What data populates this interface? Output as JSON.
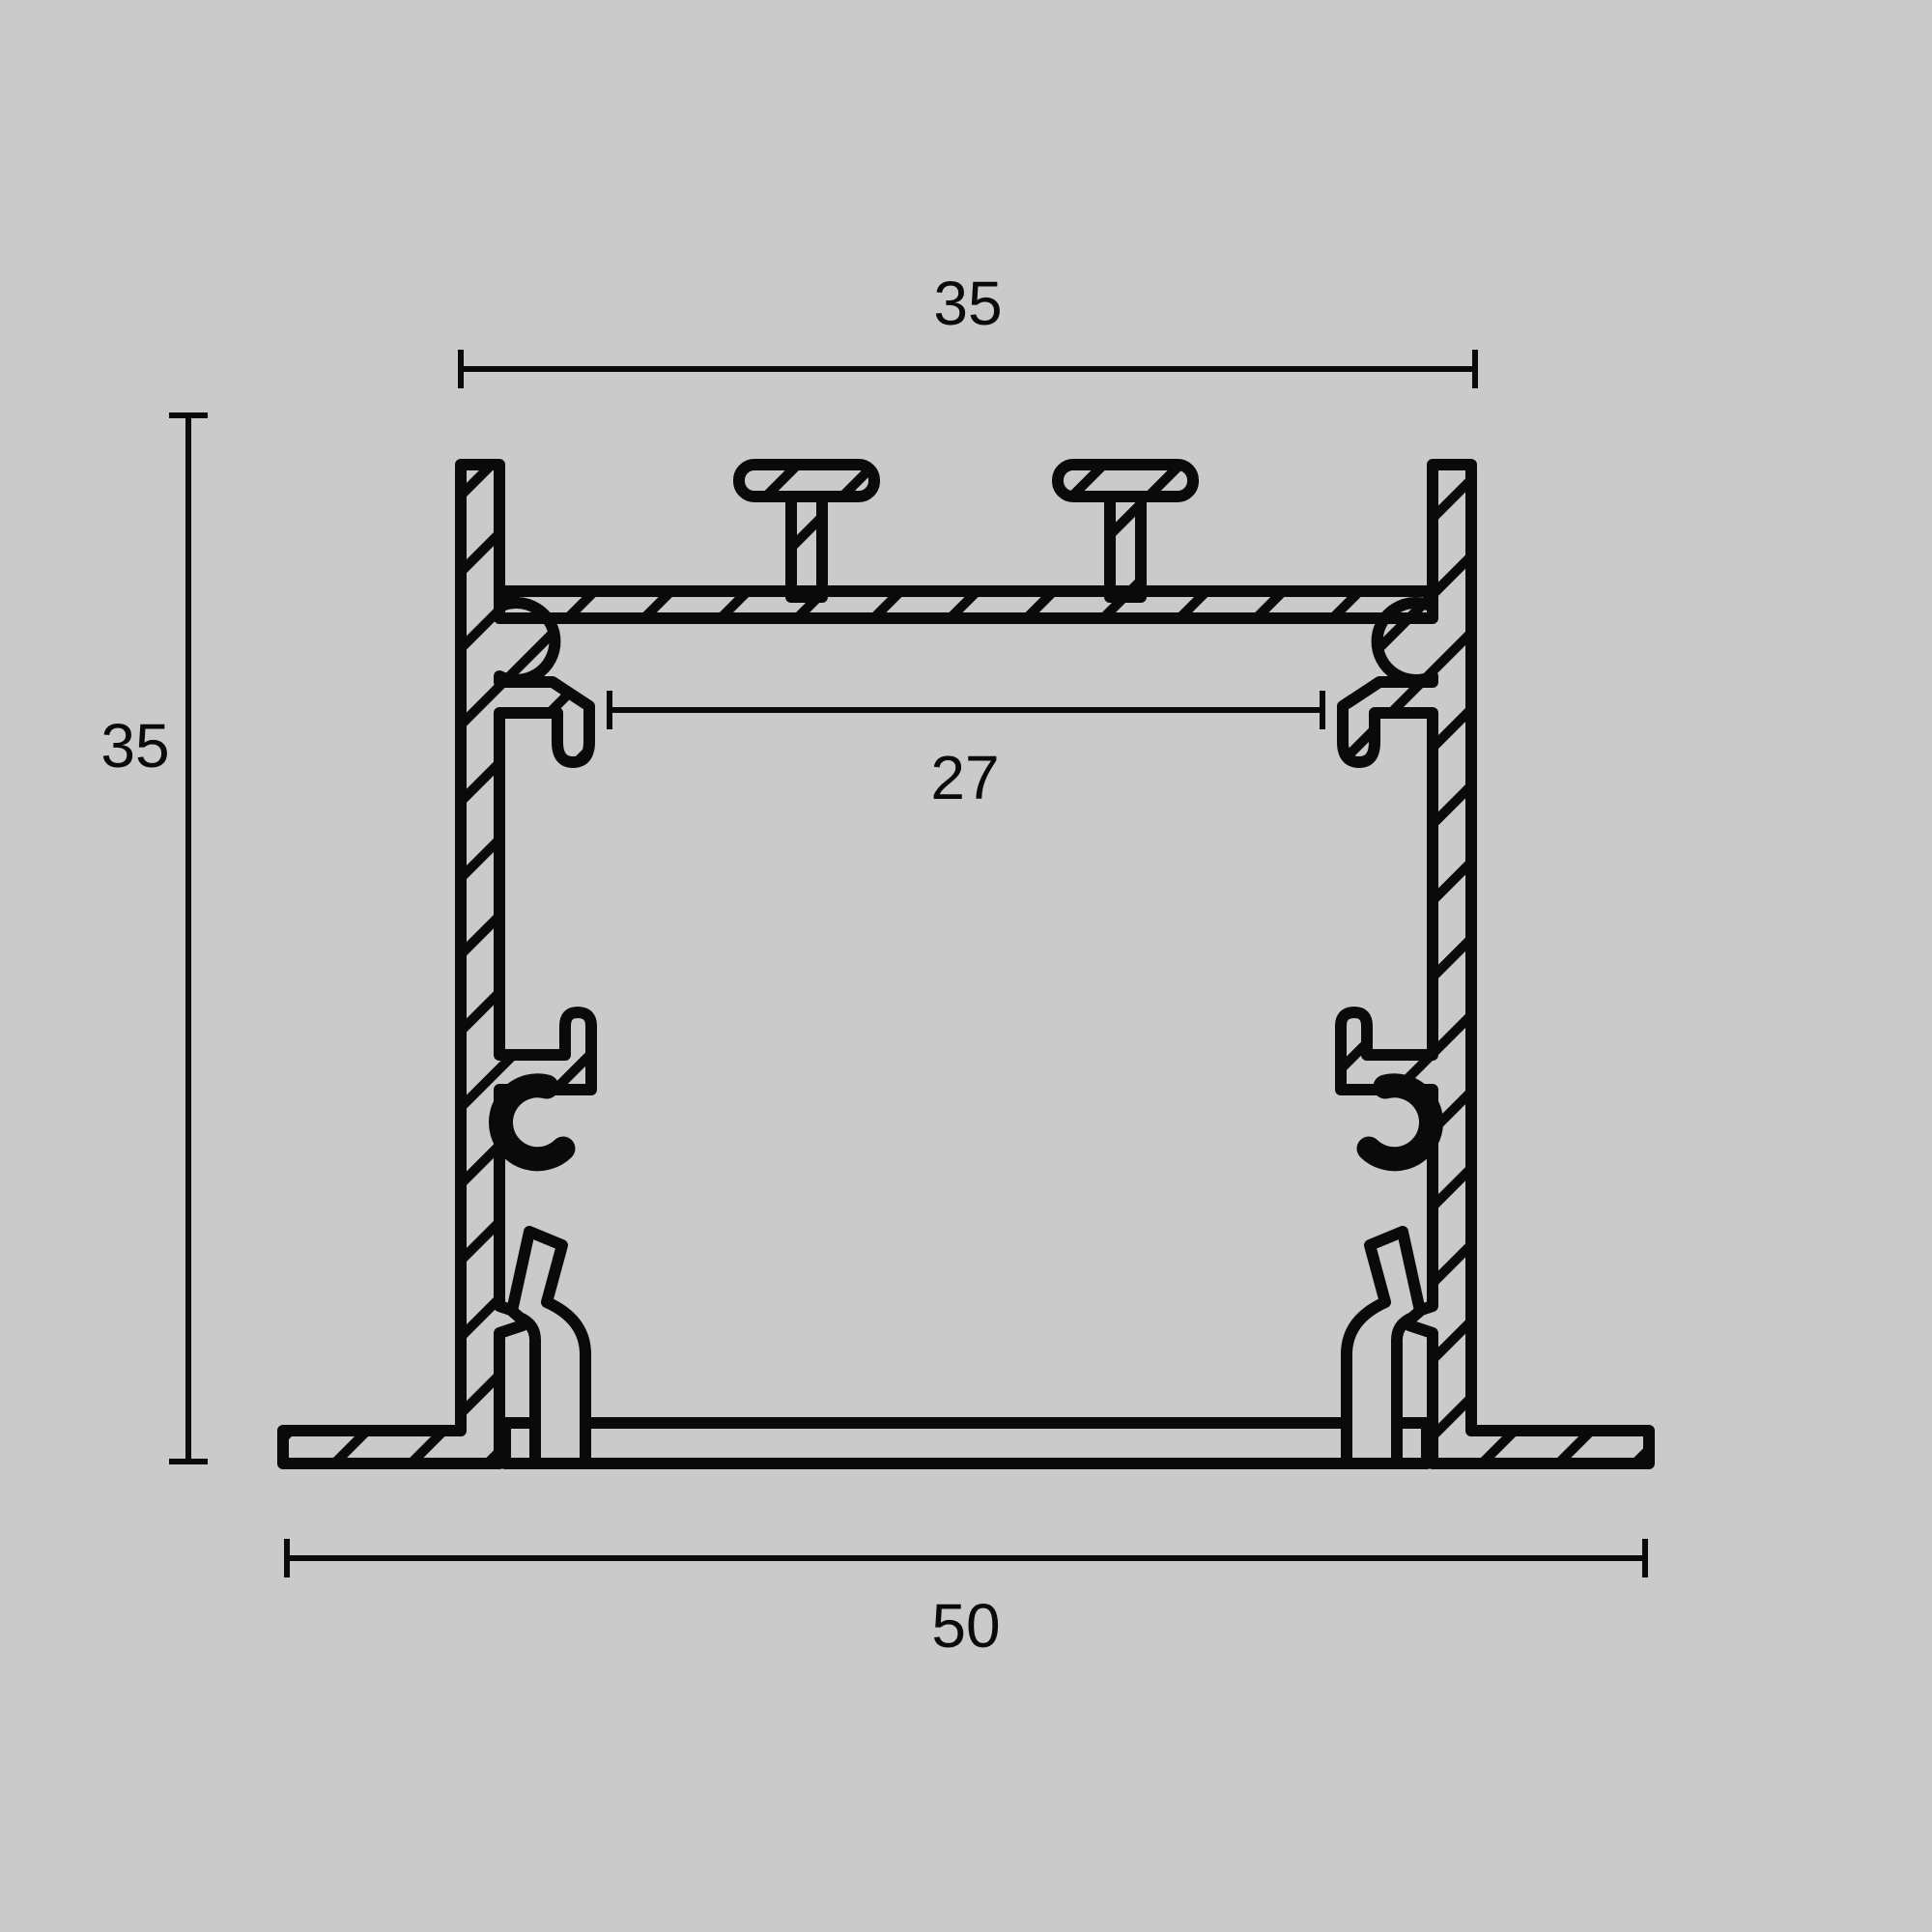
{
  "diagram": {
    "type": "technical-cross-section",
    "subject": "aluminium recessed LED profile cross-section drawing",
    "background_color": "#cacaca",
    "line_color": "#0a0a0a",
    "dimensions": {
      "top_width_label": "35",
      "height_label": "35",
      "inner_width_label": "27",
      "bottom_width_label": "50"
    }
  }
}
